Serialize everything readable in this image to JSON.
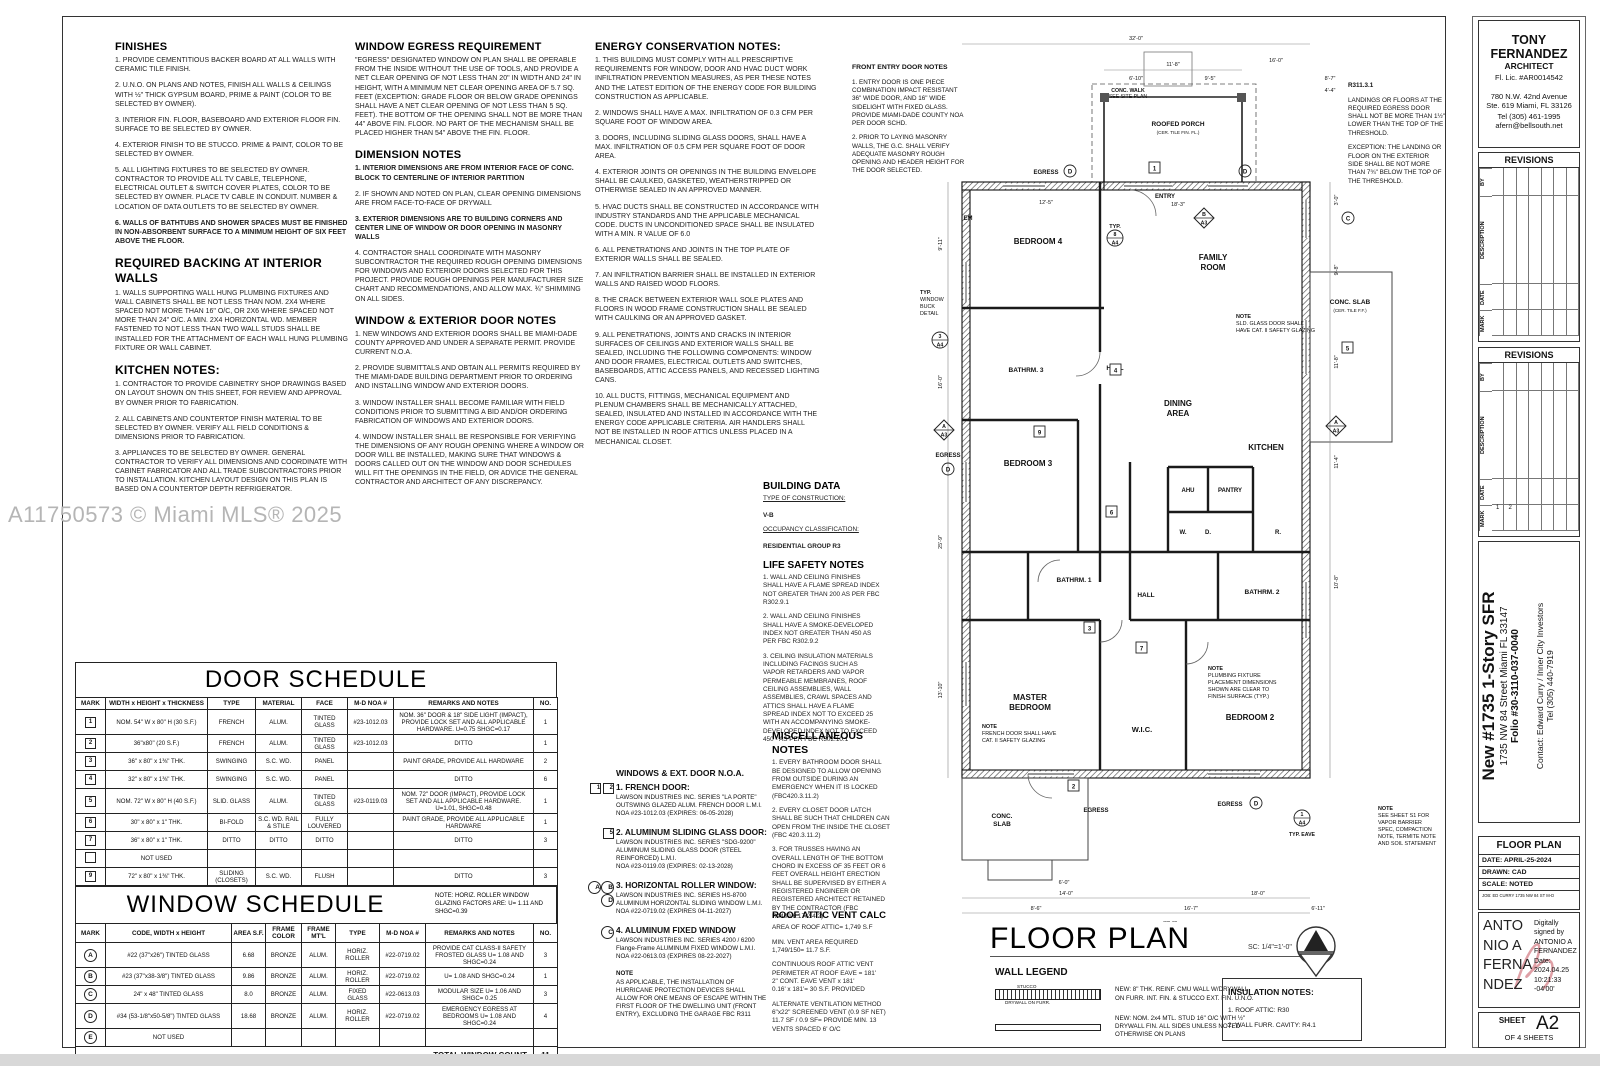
{
  "watermark": "A11750573 © Miami MLS® 2025",
  "notes": {
    "finishes": {
      "title": "FINISHES",
      "items": [
        "1. PROVIDE CEMENTITIOUS BACKER BOARD AT ALL WALLS WITH CERAMIC TILE FINISH.",
        "2. U.N.O. ON PLANS AND NOTES, FINISH ALL WALLS & CEILINGS WITH ½\" THICK GYPSUM BOARD, PRIME & PAINT (COLOR TO BE SELECTED BY OWNER).",
        "3. INTERIOR FIN. FLOOR, BASEBOARD AND EXTERIOR FLOOR FIN. SURFACE TO BE SELECTED BY OWNER.",
        "4. EXTERIOR FINISH TO BE STUCCO.  PRIME & PAINT, COLOR TO BE SELECTED BY OWNER.",
        "5. ALL LIGHTING FIXTURES TO BE SELECTED BY OWNER. CONTRACTOR TO PROVIDE ALL TV CABLE, TELEPHONE, ELECTRICAL OUTLET & SWITCH COVER PLATES, COLOR TO BE SELECTED BY OWNER. PLACE TV CABLE IN CONDUIT.  NUMBER & LOCATION OF DATA OUTLETS TO BE SELECTED BY OWNER.",
        "!6. WALLS OF BATHTUBS AND SHOWER SPACES MUST BE FINISHED IN NON-ABSORBENT SURFACE TO A MINIMUM HEIGHT OF SIX FEET ABOVE THE FLOOR."
      ]
    },
    "backing": {
      "title": "REQUIRED BACKING AT INTERIOR WALLS",
      "items": [
        "1. WALLS SUPPORTING WALL HUNG PLUMBING FIXTURES AND WALL CABINETS SHALL BE NOT LESS THAN NOM. 2X4 WHERE SPACED NOT MORE THAN 16\" O/C, OR 2X6 WHERE SPACED NOT MORE THAN 24\" O/C. A MIN. 2X4 HORIZONTAL WD. MEMBER FASTENED TO NOT LESS THAN TWO WALL STUDS SHALL BE INSTALLED FOR THE ATTACHMENT OF EACH WALL HUNG PLUMBING FIXTURE OR WALL CABINET."
      ]
    },
    "kitchen": {
      "title": "KITCHEN NOTES:",
      "items": [
        "1. CONTRACTOR TO PROVIDE CABINETRY SHOP DRAWINGS BASED ON LAYOUT SHOWN ON THIS SHEET, FOR REVIEW AND APPROVAL BY OWNER PRIOR TO FABRICATION.",
        "2. ALL CABINETS AND COUNTERTOP FINISH MATERIAL TO BE SELECTED BY OWNER. VERIFY ALL FIELD CONDITIONS & DIMENSIONS PRIOR TO FABRICATION.",
        "3. APPLIANCES TO BE SELECTED BY OWNER.  GENERAL CONTRACTOR TO VERIFY ALL DIMENSIONS AND COORDINATE WITH CABINET FABRICATOR AND ALL TRADE SUBCONTRACTORS PRIOR TO INSTALLATION.  KITCHEN LAYOUT DESIGN ON THIS PLAN IS BASED ON A COUNTERTOP DEPTH REFRIGERATOR."
      ]
    },
    "egress": {
      "title": "WINDOW EGRESS REQUIREMENT",
      "items": [
        "\"EGRESS\" DESIGNATED WINDOW ON PLAN SHALL BE OPERABLE FROM THE INSIDE WITHOUT THE USE OF TOOLS, AND PROVIDE A NET CLEAR OPENING OF NOT LESS THAN 20\" IN WIDTH AND 24\" IN HEIGHT, WITH A MINIMUM NET CLEAR OPENING AREA OF 5.7 SQ. FEET (EXCEPTION: GRADE FLOOR OR BELOW GRADE OPENINGS SHALL HAVE A NET CLEAR OPENING OF NOT LESS THAN 5 SQ. FEET).  THE BOTTOM OF THE OPENING SHALL NOT BE MORE THAN 44\" ABOVE FIN. FLOOR.  NO PART OF THE MECHANISM SHALL BE PLACED HIGHER THAN 54\" ABOVE THE FIN. FLOOR."
      ]
    },
    "dimension": {
      "title": "DIMENSION NOTES",
      "items": [
        "!1. INTERIOR DIMENSIONS ARE FROM INTERIOR FACE OF CONC. BLOCK TO CENTERLINE OF INTERIOR PARTITION",
        "2. IF SHOWN AND NOTED ON PLAN, CLEAR OPENING DIMENSIONS ARE FROM FACE-TO-FACE OF DRYWALL",
        "!3. EXTERIOR DIMENSIONS ARE TO BUILDING CORNERS AND CENTER LINE OF WINDOW OR DOOR OPENING IN MASONRY WALLS",
        "4. CONTRACTOR SHALL COORDINATE WITH MASONRY SUBCONTRACTOR THE REQUIRED ROUGH OPENING DIMENSIONS FOR WINDOWS AND EXTERIOR DOORS SELECTED FOR THIS PROJECT. PROVIDE ROUGH OPENINGS PER MANUFACTURER SIZE CHART AND RECOMMENDATIONS, AND ALLOW  MAX. ¾\" SHIMMING ON ALL SIDES."
      ]
    },
    "windoor": {
      "title": "WINDOW & EXTERIOR DOOR NOTES",
      "items": [
        "1. NEW WINDOWS AND EXTERIOR DOORS SHALL BE MIAMI-DADE COUNTY APPROVED AND UNDER A SEPARATE PERMIT.   PROVIDE CURRENT N.O.A.",
        "2. PROVIDE SUBMITTALS AND OBTAIN ALL PERMITS REQUIRED BY THE MIAMI-DADE BUILDING DEPARTMENT PRIOR TO ORDERING AND INSTALLING WINDOW AND EXTERIOR DOORS.",
        "3. WINDOW INSTALLER SHALL BECOME FAMILIAR WITH FIELD CONDITIONS PRIOR TO SUBMITTING A BID AND/OR ORDERING FABRICATION OF WINDOWS AND EXTERIOR DOORS.",
        "4. WINDOW INSTALLER SHALL BE RESPONSIBLE FOR VERIFYING THE DIMENSIONS OF ANY ROUGH OPENING WHERE A WINDOW OR DOOR WILL BE INSTALLED, MAKING SURE THAT WINDOWS & DOORS CALLED OUT ON THE WINDOW AND DOOR SCHEDULES WILL FIT THE OPENINGS IN THE FIELD, OR ADVICE THE GENERAL CONTRACTOR AND ARCHITECT OF ANY DISCREPANCY."
      ]
    },
    "energy": {
      "title": "ENERGY CONSERVATION NOTES:",
      "items": [
        "1.  THIS BUILDING MUST COMPLY WITH ALL PRESCRIPTIVE REQUIREMENTS FOR WINDOW, DOOR AND HVAC DUCT WORK INFILTRATION PREVENTION MEASURES, AS PER THESE NOTES AND THE LATEST EDITION OF THE ENERGY CODE FOR BUILDING CONSTRUCTION AS APPLICABLE.",
        "2.  WINDOWS SHALL HAVE A MAX. INFILTRATION OF 0.3 CFM PER SQUARE FOOT OF WINDOW AREA.",
        "3.  DOORS, INCLUDING SLIDING GLASS DOORS, SHALL HAVE A MAX. INFILTRATION OF 0.5 CFM PER SQUARE FOOT OF DOOR AREA.",
        "4.  EXTERIOR JOINTS OR OPENINGS IN THE BUILDING ENVELOPE SHALL BE CAULKED, GASKETED, WEATHERSTRIPPED OR OTHERWISE SEALED IN AN APPROVED MANNER.",
        "5.  HVAC DUCTS SHALL BE CONSTRUCTED IN ACCORDANCE WITH INDUSTRY STANDARDS AND THE APPLICABLE MECHANICAL CODE.  DUCTS IN UNCONDITIONED SPACE SHALL BE INSULATED WITH A MIN. R VALUE OF 6.0",
        "6.  ALL PENETRATIONS AND JOINTS IN THE TOP PLATE OF EXTERIOR WALLS SHALL BE SEALED.",
        "7.  AN INFILTRATION BARRIER SHALL BE INSTALLED IN EXTERIOR WALLS AND RAISED WOOD FLOORS.",
        "8.  THE CRACK BETWEEN EXTERIOR WALL SOLE PLATES AND FLOORS IN WOOD FRAME CONSTRUCTION SHALL BE SEALED WITH CAULKING OR AN APPROVED GASKET.",
        "9.  ALL PENETRATIONS, JOINTS AND CRACKS IN INTERIOR SURFACES OF CEILINGS AND EXTERIOR WALLS SHALL BE SEALED, INCLUDING THE FOLLOWING COMPONENTS: WINDOW AND DOOR FRAMES, ELECTRICAL OUTLETS AND SWITCHES, BASEBOARDS, ATTIC ACCESS PANELS, AND RECESSED LIGHTING CANS.",
        "10.  ALL DUCTS, FITTINGS, MECHANICAL EQUIPMENT AND PLENUM CHAMBERS SHALL BE MECHANICALLY ATTACHED, SEALED, INSULATED AND INSTALLED IN ACCORDANCE WITH THE ENERGY CODE APPLICABLE CRITERIA.  AIR HANDLERS SHALL NOT BE INSTALLED IN ROOF ATTICS UNLESS PLACED IN A MECHANICAL CLOSET."
      ]
    },
    "front_entry": {
      "title": "FRONT ENTRY DOOR NOTES",
      "items": [
        "1. ENTRY DOOR IS ONE PIECE COMBINATION IMPACT RESISTANT 36\" WIDE DOOR, AND 16\" WIDE SIDELIGHT WITH FIXED GLASS.  PROVIDE MIAMI-DADE COUNTY NOA PER DOOR SCHD.",
        "2. PRIOR TO LAYING MASONRY WALLS, THE G.C. SHALL VERIFY ADEQUATE MASONRY ROUGH OPENING AND HEADER HEIGHT FOR THE DOOR SELECTED."
      ]
    },
    "r311": {
      "title": "R311.3.1",
      "items": [
        "LANDINGS OR FLOORS AT THE REQUIRED EGRESS DOOR SHALL NOT BE MORE THAN 1½\" LOWER THAN THE TOP OF THE THRESHOLD.",
        "!EXCEPTION: THE LANDING OR FLOOR ON THE EXTERIOR SIDE SHALL BE NOT MORE THAN 7¾\" BELOW THE TOP OF THE THRESHOLD."
      ]
    }
  },
  "building_data": {
    "title": "BUILDING DATA",
    "construction_label": "TYPE OF CONSTRUCTION:",
    "construction_value": "V-B",
    "occupancy_label": "OCCUPANCY CLASSIFICATION:",
    "occupancy_value": "RESIDENTIAL GROUP R3"
  },
  "life_safety": {
    "title": "LIFE SAFETY NOTES",
    "items": [
      "1.  WALL AND CEILING FINISHES SHALL HAVE A FLAME SPREAD INDEX NOT GREATER THAN 200 AS PER FBC R302.9.1",
      "2.  WALL AND CEILING FINISHES SHALL HAVE A SMOKE-DEVELOPED INDEX NOT GREATER THAN 450 AS PER FBC R302.9.2",
      "3.  CEILING INSULATION MATERIALS INCLUDING FACINGS SUCH AS VAPOR RETARDERS AND VAPOR PERMEABLE MEMBRANES, ROOF CEILING ASSEMBLIES, WALL ASSEMBLIES, CRAWL SPACES AND ATTICS SHALL HAVE A FLAME SPREAD INDEX NOT TO EXCEED 25 WITH AN ACCOMPANYING SMOKE-DEVELOPED INDEX NOT TO EXCEED 450 - AS PER FBC R302.10.1"
    ]
  },
  "misc": {
    "title": "MISCELLANEOUS NOTES",
    "items": [
      "1.  EVERY BATHROOM DOOR SHALL BE DESIGNED TO ALLOW OPENING FROM OUTSIDE DURING AN EMERGENCY WHEN IT IS LOCKED (FBC420.3.11.2)",
      "2.  EVERY CLOSET DOOR LATCH SHALL BE SUCH THAT CHILDREN CAN OPEN FROM THE INSIDE THE CLOSET (FBC 420.3.11.2)",
      "3.  FOR TRUSSES HAVING AN OVERALL LENGTH OF THE BOTTOM CHORD IN EXCESS OF 35 FEET OR 6 FEET OVERALL HEIGHT ERECTION SHALL BE SUPERVISED BY EITHER A REGISTERED ENGINEER OR REGISTERED ARCHITECT RETAINED BY THE CONTRACTOR (FBC R4409.6.17.2.4.2)"
    ]
  },
  "vent": {
    "title": "ROOF ATTIC VENT CALC",
    "items": [
      "AREA OF ROOF ATTIC= 1,749 S.F",
      "MIN. VENT AREA REQUIRED\n1,749/150= 11.7 S.F.",
      "CONTINUOUS ROOF ATTIC VENT\nPERIMETER AT ROOF EAVE = 181'\n2\" CONT. EAVE VENT x 181'\n0.16' x 181'= 30 S.F. PROVIDED",
      "ALTERNATE VENTILATION METHOD\n6\"x22\" SCREENED VENT (0.9 SF NET)\n11.7 SF / 0.9 SF= PROVIDE MIN. 13 VENTS SPACED 6' O/C"
    ]
  },
  "noa": {
    "title": "WINDOWS & EXT. DOOR N.O.A.",
    "entries": [
      {
        "marks": [
          "1",
          "2"
        ],
        "style": "box",
        "title": "1. FRENCH DOOR:",
        "lines": "LAWSON INDUSTRIES INC. SERIES \"LA PORTE\"\nOUTSWING GLAZED ALUM. FRENCH DOOR L.M.I.\nNOA #23-1012.03 (EXPIRES: 06-05-2028)"
      },
      {
        "marks": [
          "5"
        ],
        "style": "box",
        "title": "2. ALUMINUM SLIDING GLASS DOOR:",
        "lines": "LAWSON INDUSTRIES INC. SERIES \"SDG-9200\"\nALUMINUM SLIDING GLASS DOOR (STEEL\nREINFORCED) L.M.I.\nNOA #23-0119.03 (EXPIRES: 02-13-2028)"
      },
      {
        "marks": [
          "A",
          "B",
          "D"
        ],
        "style": "circ",
        "title": "3. HORIZONTAL ROLLER WINDOW:",
        "lines": "LAWSON INDUSTRIES INC.  SERIES HS-8700\nALUMINUM HORIZONTAL SLIDING WINDOW L.M.I.\nNOA #22-0719.02 (EXPIRES 04-11-2027)"
      },
      {
        "marks": [
          "C"
        ],
        "style": "circ",
        "title": "4. ALUMINUM FIXED WINDOW",
        "lines": "LAWSON INDUSTRIES INC.  SERIES 4200 / 6200\nFlange-Frame ALUMINUM FIXED WINDOW L.M.I.\nNOA #22-0613.03 (EXPIRES 08-22-2027)"
      }
    ],
    "note_title": "NOTE",
    "note": "AS APPLICABLE, THE INSTALLATION OF HURRICANE PROTECTION DEVICES SHALL ALLOW FOR ONE MEANS OF ESCAPE WITHIN THE FIRST FLOOR OF THE DWELLING UNIT (FRONT ENTRY), EXCLUDING THE GARAGE FBC R311"
  },
  "door_schedule": {
    "title": "DOOR SCHEDULE",
    "headers": [
      "MARK",
      "WIDTH x HEIGHT x THICKNESS",
      "TYPE",
      "MATERIAL",
      "FACE",
      "M-D NOA #",
      "REMARKS AND NOTES",
      "NO."
    ],
    "rows": [
      [
        "1",
        "NOM. 54\" W x 80\" H (30 S.F.)",
        "FRENCH",
        "ALUM.",
        "TINTED GLASS",
        "#23-1012.03",
        "NOM. 36\" DOOR & 18\" SIDE LIGHT (IMPACT), PROVIDE LOCK SET AND ALL APPLICABLE HARDWARE.  U=0.75  SHGC=0.17",
        "1"
      ],
      [
        "2",
        "36\"x80\" (20 S.F.)",
        "FRENCH",
        "ALUM.",
        "TINTED GLASS",
        "#23-1012.03",
        "DITTO",
        "1"
      ],
      [
        "3",
        "36\" x 80\" x 1⅜\" THK.",
        "SWINGING",
        "S.C. WD.",
        "PANEL",
        "",
        "PAINT GRADE, PROVIDE ALL HARDWARE",
        "2"
      ],
      [
        "4",
        "32\" x 80\" x 1⅜\" THK.",
        "SWINGING",
        "S.C. WD.",
        "PANEL",
        "",
        "DITTO",
        "6"
      ],
      [
        "5",
        "NOM. 72\" W x 80\" H (40 S.F.)",
        "SLID. GLASS",
        "ALUM.",
        "TINTED GLASS",
        "#23-0119.03",
        "NOM. 72\" DOOR (IMPACT), PROVIDE LOCK SET AND ALL APPLICABLE HARDWARE.  U=1.01, SHGC=0.48",
        "1"
      ],
      [
        "6",
        "30\" x 80\" x 1\" THK.",
        "BI-FOLD",
        "S.C. WD. RAIL & STILE",
        "FULLY LOUVERED",
        "",
        "PAINT GRADE, PROVIDE ALL APPLICABLE HARDWARE",
        "1"
      ],
      [
        "7",
        "36\" x 80\" x 1\" THK.",
        "DITTO",
        "DITTO",
        "DITTO",
        "",
        "DITTO",
        "3"
      ],
      [
        "",
        "NOT USED",
        "",
        "",
        "",
        "",
        "",
        ""
      ],
      [
        "9",
        "72\" x 80\" x 1⅜\" THK.",
        "SLIDING (CLOSETS)",
        "S.C. WD.",
        "FLUSH",
        "",
        "DITTO",
        "3"
      ],
      [
        "",
        "NOT USED",
        "",
        "",
        "",
        "",
        "",
        ""
      ],
      [
        "",
        "NOT USED",
        "",
        "",
        "",
        "",
        "",
        ""
      ]
    ],
    "total_label": "TOTAL DOOR COUNT",
    "total": "18"
  },
  "window_schedule": {
    "title": "WINDOW SCHEDULE",
    "note": "NOTE:  HORIZ. ROLLER WINDOW GLAZING FACTORS ARE:  U= 1.11 AND SHGC=0.39",
    "headers": [
      "MARK",
      "CODE, WIDTH x HEIGHT",
      "AREA S.F.",
      "FRAME COLOR",
      "FRAME MT'L",
      "TYPE",
      "M-D NOA #",
      "REMARKS AND NOTES",
      "NO."
    ],
    "rows": [
      [
        "A",
        "#22 (37\"x26\") TINTED GLASS",
        "6.68",
        "BRONZE",
        "ALUM.",
        "HORIZ. ROLLER",
        "#22-0719.02",
        "PROVIDE CAT CLASS-II SAFETY FROSTED GLASS U= 1.08 AND SHGC=0.24",
        "3"
      ],
      [
        "B",
        "#23 (37\"x38-3/8\") TINTED GLASS",
        "9.86",
        "BRONZE",
        "ALUM.",
        "HORIZ. ROLLER",
        "#22-0719.02",
        "U= 1.08 AND SHGC=0.24",
        "1"
      ],
      [
        "C",
        "24\" x 48\" TINTED GLASS",
        "8.0",
        "BRONZE",
        "ALUM.",
        "FIXED GLASS",
        "#22-0613.03",
        "MODULAR SIZE U= 1.06 AND SHGC= 0.25",
        "3"
      ],
      [
        "D",
        "#34 (53-1/8\"x50-5/8\") TINTED GLASS",
        "18.68",
        "BRONZE",
        "ALUM.",
        "HORIZ. ROLLER",
        "#22-0719.02",
        "EMERGENCY EGRESS AT BEDROOMS U= 1.08 AND SHGC=0.24",
        "4"
      ],
      [
        "E",
        "NOT USED",
        "",
        "",
        "",
        "",
        "",
        "",
        ""
      ]
    ],
    "total_label": "TOTAL WINDOW COUNT",
    "total": "11"
  },
  "floor_plan": {
    "title": "FLOOR PLAN",
    "scale": "SC: 1/4\"=1'-0\"",
    "labels": {
      "bedroom4": "BEDROOM 4",
      "family": [
        "FAMILY",
        "ROOM"
      ],
      "bathrm3": "BATHRM. 3",
      "hall1": "HALL",
      "dining": [
        "DINING",
        "AREA"
      ],
      "bedroom3": "BEDROOM 3",
      "kitchen": "KITCHEN",
      "ahu": "AHU",
      "pantry": "PANTRY",
      "bathrm1": "BATHRM. 1",
      "hall2": "HALL",
      "w": "W.",
      "d": "D.",
      "r": "R.",
      "bathrm2": "BATHRM. 2",
      "master": [
        "MASTER",
        "BEDROOM"
      ],
      "wic": "W.I.C.",
      "bedroom2": "BEDROOM 2",
      "conc_right": [
        "CONC. SLAB",
        "(CER. TILE F.F.)"
      ],
      "conc_bl": [
        "CONC.",
        "SLAB"
      ],
      "porch": [
        "ROOFED PORCH",
        "(CER. TILE FIN. FL.)"
      ],
      "conc_walk": [
        "CONC. WALK",
        "SEE SITE PLAN"
      ],
      "entry": "ENTRY",
      "em": "EM",
      "egress": "EGRESS",
      "typ": "TYP.",
      "typ_eave": "TYP. EAVE"
    },
    "notes": {
      "sld": [
        "NOTE",
        "SLD. GLASS DOOR SHALL",
        "HAVE CAT. II SAFETY GLAZING"
      ],
      "french": [
        "NOTE",
        "FRENCH DOOR SHALL HAVE",
        "CAT. II SAFETY GLAZING"
      ],
      "plumb": [
        "NOTE",
        "PLUMBING FIXTURE",
        "PLACEMENT DIMENSIONS",
        "SHOWN ARE CLEAR TO",
        "FINISH SURFACE (TYP.)"
      ],
      "s1": [
        "NOTE",
        "SEE SHEET S1 FOR",
        "VAPOR BARRIER",
        "SPEC, COMPACTION",
        "NOTE, TERMITE NOTE",
        "AND SOIL STATEMENT"
      ],
      "buck": [
        "TYP.",
        "WINDOW",
        "BUCK",
        "DETAIL"
      ]
    },
    "dims": {
      "top32": "32'-0\"",
      "t118": "11'-8\"",
      "t610": "6'-10\"",
      "t95": "9'-5\"",
      "t160": "16'-0\"",
      "t87": "8'-7\"",
      "t44": "4'-4\"",
      "t183": "18'-3\"",
      "t125": "12'-5\"",
      "b60": "6'-0\"",
      "b140": "14'-0\"",
      "b180": "18'-0\"",
      "b86": "8'-6\"",
      "b167": "16'-7\"",
      "b611": "6'-11\"",
      "b32": "32'-0\"",
      "r30": "3'-0\"",
      "r98": "9'-8\"",
      "r118": "11'-8\"",
      "r114": "11'-4\"",
      "r108": "10'-8\"",
      "l911": "9'-11\"",
      "l259": "25'-9\"",
      "l1310": "13'-10\"",
      "l160": "16'-0\""
    },
    "markers": {
      "m1": "1",
      "m2": "2",
      "m3": "3",
      "m4": "4",
      "m5": "5",
      "m6": "6",
      "m7": "7",
      "m9": "9",
      "m8": "8",
      "mA": "A",
      "mB": "B",
      "mC": "C",
      "mD": "D",
      "a3": "A3",
      "a4": "A4"
    }
  },
  "legend": {
    "title": "WALL LEGEND",
    "stucco": "STUCCO",
    "drywall": "DRYWALL ON FURR.",
    "item1": "NEW:  8\" THK. REINF. CMU WALL W/DRYWALL\nON FURR. INT. FIN. & STUCCO EXT. FIN. U.N.O.",
    "item2": "NEW: NOM. 2x4 MTL. STUD 16\" O/C WITH ½\"\nDRYWALL FIN. ALL SIDES UNLESS NOTED\nOTHERWISE ON PLANS"
  },
  "insulation": {
    "title": "INSULATION NOTES:",
    "items": [
      "1. ROOF ATTIC: R30",
      "2. WALL FURR. CAVITY: R4.1"
    ]
  },
  "titleblock": {
    "architect": {
      "name": "TONY FERNANDEZ",
      "role": "ARCHITECT",
      "license": "Fl. Lic. #AR0014542",
      "address1": "780 N.W. 42nd Avenue",
      "address2": "Ste. 619 Miami, FL 33126",
      "phone": "Tel (305) 461-1995",
      "email": "afern@bellsouth.net"
    },
    "revisions": {
      "header": "REVISIONS",
      "by": "BY",
      "description": "DESCRIPTION",
      "date": "DATE",
      "mark": "MARK",
      "marks2": [
        "1",
        "2"
      ]
    },
    "project": {
      "title": "New #1735 1-Story SFR",
      "address": "1735 NW 84 Street Miami FL 33147",
      "folio": "Folio #30-3110-037-0040",
      "contact1": "Contact:  Edward Curry / Inner City Investors",
      "contact2": "Tel (305) 440-7919"
    },
    "info": {
      "sheet_title": "FLOOR PLAN",
      "date": "DATE:  APRIL-25-2024",
      "drawn": "DRAWN:  CAD",
      "scale": "SCALE:  NOTED",
      "job": "JOB:  ED CURRY 1735 NW 84 ST M-D"
    },
    "signature": {
      "name_lines": "ANTO\nNIO A\nFERNA\nNDEZ",
      "detail": "Digitally\nsigned by\nANTONIO A\nFERNANDEZ\nDate:\n2024.04.25\n10:21:33\n-04'00'",
      "flourish_color": "#d98f96"
    },
    "sheet": {
      "label": "SHEET",
      "number": "A2",
      "of": "OF 4 SHEETS"
    }
  }
}
